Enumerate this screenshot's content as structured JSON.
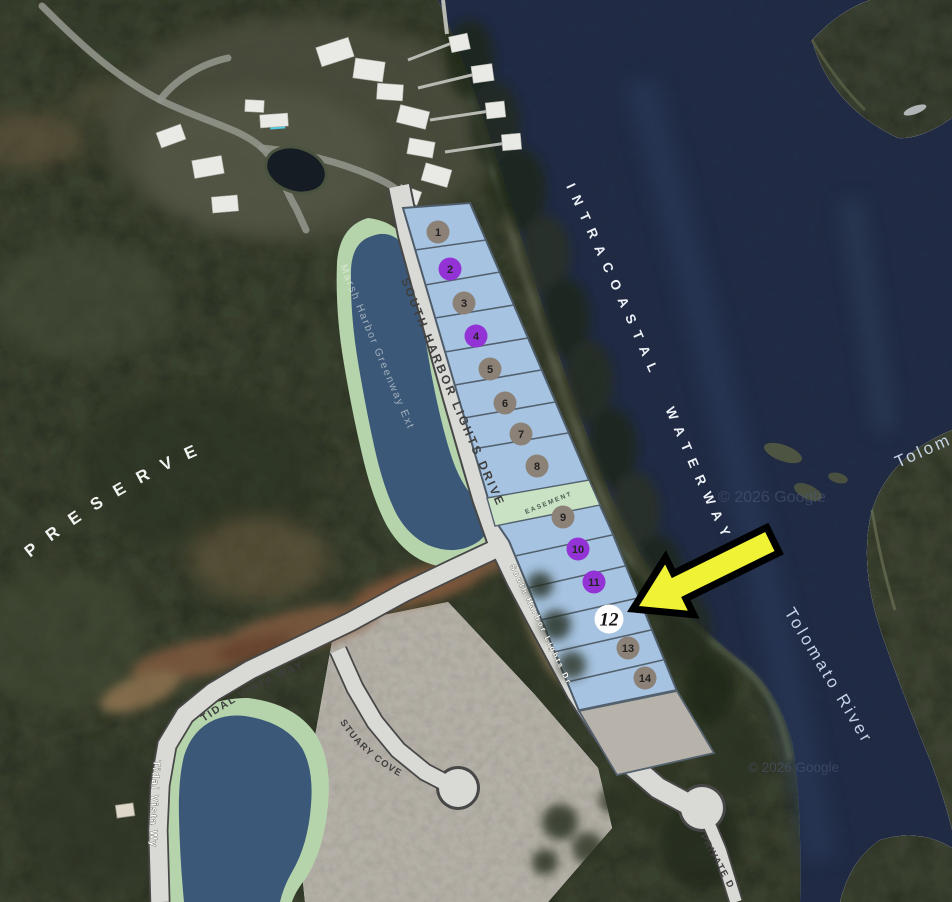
{
  "map": {
    "area_labels": {
      "preserve": "PRESERVE",
      "intracoastal_waterway": "INTRACOASTAL WATERWAY",
      "tolomato_river": "Tolomato River",
      "tolomato_partial": "Tolom"
    },
    "street_labels": {
      "south_harbor_lights_drive": "SOUTH HARBOR LIGHTS DRIVE",
      "south_harbor_lights_dr_small": "South Harbor Lights Dr",
      "tidal_vista_way": "TIDAL VISTA WAY",
      "tidal_vista_wy_small": "Tidal Vista Wy",
      "stuary_cove": "STUARY COVE",
      "private_drive": "PRIVATE D",
      "marsh_harbor_greenway": "Marsh Harbor Greenway Ext",
      "easement": "EASEMENT"
    },
    "watermark": "© 2026 Google",
    "lot_fill": "#a6c3e1",
    "easement_fill": "#c9e2c4",
    "marker_colors": {
      "gray": "#8c8177",
      "purple": "#9333d6",
      "white": "#ffffff"
    },
    "lots": [
      {
        "number": "1",
        "marker": "gray"
      },
      {
        "number": "2",
        "marker": "purple"
      },
      {
        "number": "3",
        "marker": "gray"
      },
      {
        "number": "4",
        "marker": "purple"
      },
      {
        "number": "5",
        "marker": "gray"
      },
      {
        "number": "6",
        "marker": "gray"
      },
      {
        "number": "7",
        "marker": "gray"
      },
      {
        "number": "8",
        "marker": "gray"
      },
      {
        "number": "9",
        "marker": "gray"
      },
      {
        "number": "10",
        "marker": "purple"
      },
      {
        "number": "11",
        "marker": "purple"
      },
      {
        "number": "12",
        "marker": "white",
        "highlighted": true
      },
      {
        "number": "13",
        "marker": "gray"
      },
      {
        "number": "14",
        "marker": "gray"
      }
    ],
    "arrow": {
      "fill": "#f0f335",
      "outline": "#000000",
      "points_to_lot": "12"
    }
  }
}
